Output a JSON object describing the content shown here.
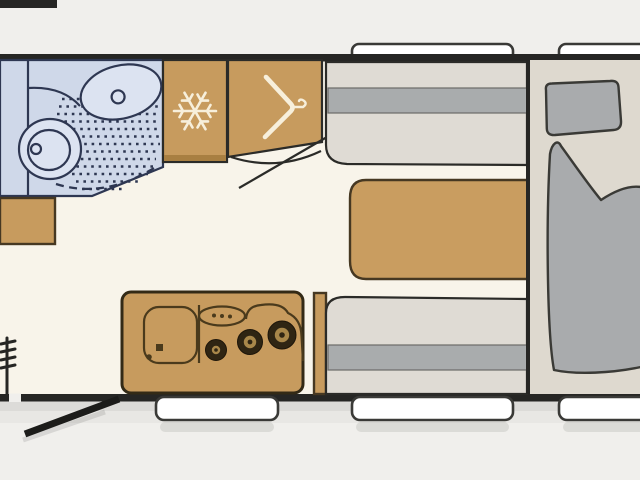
{
  "meta": {
    "title": "Caravan floor plan — top view"
  },
  "colors": {
    "outside": "#f0efec",
    "floor": "#f8f4ea",
    "wall": "#262624",
    "bath": "#cfd8e9",
    "bath_fixture": "#dce3f1",
    "wood": "#c79b5e",
    "wood_dark": "#a87f42",
    "bench": "#dfdbd4",
    "stripe": "#a9acad",
    "bed_base": "#ded9cf",
    "bedding": "#a9abad",
    "window": "#ffffff",
    "icon_cream": "#f7efdb",
    "burner_dark": "#2f2513",
    "burner_mid": "#a8874a",
    "knob_dark": "#4a3a1c"
  },
  "fixtures": {
    "washroom": "Washroom with shower, basin and toilet",
    "washbasin": "Washbasin",
    "toilet": "Toilet",
    "shower": "Shower floor",
    "refrigerator": "Refrigerator",
    "snowflake": "Snowflake icon",
    "wardrobe": "Wardrobe",
    "hanger": "Clothes-hanger icon",
    "front_cabinet": "Front cabinet",
    "side_cabinet": "Side cabinet",
    "seat_top": "Dinette bench seat",
    "seat_bottom": "Dinette bench seat",
    "table": "Dinette table",
    "kitchen": "Kitchen unit with sink and 3-burner hob",
    "sink": "Kitchen sink",
    "hob": "Gas hob",
    "bed": "Double bed with pillow and duvet",
    "pillow": "Pillow",
    "duvet": "Duvet",
    "door": "Entrance door (open)",
    "step": "Entry step",
    "window": "Window"
  }
}
